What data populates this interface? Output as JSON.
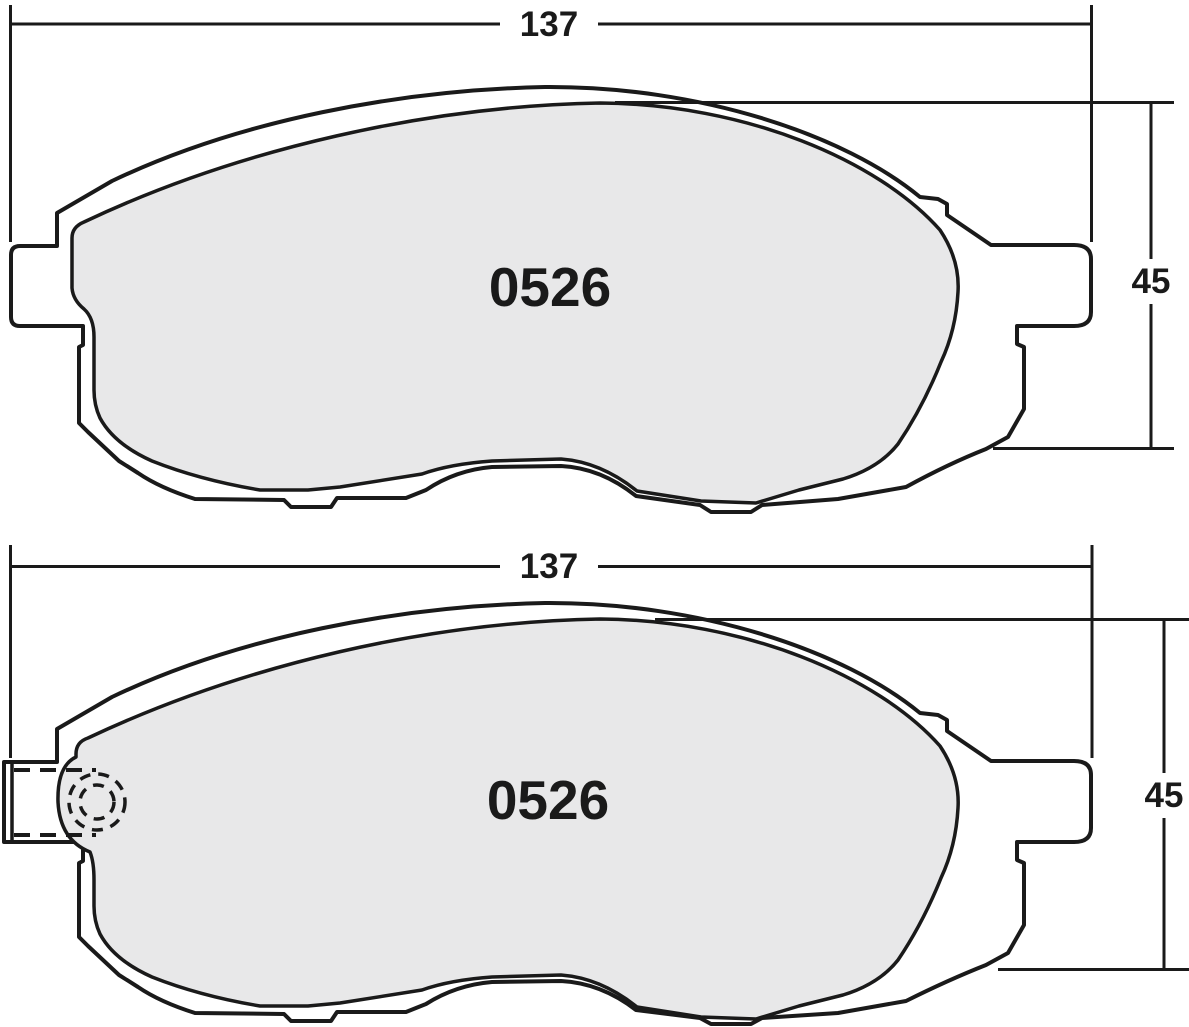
{
  "drawing": {
    "type": "brake-pad-technical-drawing",
    "background_color": "#ffffff",
    "line_color": "#1a1a1a",
    "friction_fill": "#e8e8e9",
    "plate_fill": "#ffffff",
    "views": [
      {
        "name": "pad-outer-view",
        "part_number": "0526",
        "dimensions": {
          "width_mm": "137",
          "height_mm": "45"
        }
      },
      {
        "name": "pad-inner-view-with-wear-sensor",
        "part_number": "0526",
        "dimensions": {
          "width_mm": "137",
          "height_mm": "45"
        }
      }
    ]
  }
}
